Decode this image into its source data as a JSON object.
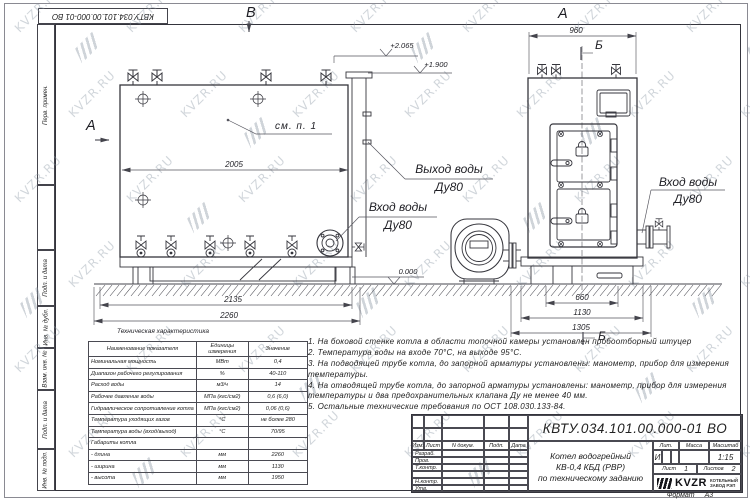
{
  "frame": {
    "doc_number_rotated": "КВТУ.034.101.00.000-01 ВО",
    "stamp_column": [
      "Перв. примен.",
      "",
      "Подп. и дата",
      "Инв. № дубл.",
      "Взам. инв. №",
      "Подп. и дата",
      "Инв. № подл."
    ],
    "format_label": "Формат",
    "format_value": "А3"
  },
  "views": {
    "left": {
      "view_marker_top": "В",
      "section_marker_side": "А",
      "callout": "см. п. 1",
      "elevation_top": "+2.065",
      "elevation_chimney": "+1.900",
      "elevation_ground": "0.000",
      "dim_length_shell": "2005",
      "dim_length_frame": "2135",
      "dim_length_overall": "2260",
      "outlet_label_line1": "Выход воды",
      "outlet_label_line2": "Ду80",
      "inlet_label_line1": "Вход воды",
      "inlet_label_line2": "Ду80"
    },
    "right": {
      "view_marker_top": "А",
      "section_marker_top": "Б",
      "section_marker_bottom": "Б",
      "dim_width_top": "960",
      "dim_width_1": "660",
      "dim_width_2": "1130",
      "dim_width_3": "1305",
      "inlet_label_line1": "Вход воды",
      "inlet_label_line2": "Ду80"
    }
  },
  "spec_table": {
    "title": "Техническая характеристика",
    "headers": [
      "Наименование показателя",
      "Единицы измерения",
      "Значение"
    ],
    "rows": [
      [
        "Номинальная мощность",
        "МВт",
        "0,4"
      ],
      [
        "Диапазон рабочего регулирования",
        "%",
        "40-110"
      ],
      [
        "Расход воды",
        "м3/ч",
        "14"
      ],
      [
        "Рабочее давление воды",
        "МПа (кгс/см2)",
        "0,6 (6,0)"
      ],
      [
        "Гидравлическое сопротивление котла",
        "МПа (кгс/см2)",
        "0,06 (0,6)"
      ],
      [
        "Температура уходящих газов",
        "°С",
        "не более 280"
      ],
      [
        "Температура воды (вход/выход)",
        "°С",
        "70/95"
      ],
      [
        "Габариты котла",
        "",
        ""
      ],
      [
        "- длина",
        "мм",
        "2260"
      ],
      [
        "- ширина",
        "мм",
        "1130"
      ],
      [
        "- высота",
        "мм",
        "1950"
      ]
    ]
  },
  "notes": [
    "1.  На боковой стенке котла в области топочной камеры установлен пробоотборный штуцер",
    "2.  Температура воды на входе 70°С, на выходе 95°С.",
    "3.  На подводящей трубе котла, до запорной арматуры установлены: манометр, прибор для измерения температуры.",
    "4.  На отводящей трубе котла, до запорной арматуры установлены: манометр, прибор для измерения температуры и два предохранительных клапана Ду не менее 40 мм.",
    "5.  Остальные технические требования по ОСТ 108.030.133-84."
  ],
  "title_block": {
    "doc_number": "КВТУ.034.101.00.000-01 ВО",
    "rev_cols": [
      "Изм.",
      "Лист",
      "N докум.",
      "Подп.",
      "Дата"
    ],
    "sign_rows": [
      "Разраб.",
      "Пров.",
      "Т.контр.",
      "",
      "Н.контр.",
      "Утв."
    ],
    "product_line1": "Котел водогрейный",
    "product_line2": "КВ-0,4  КБД  (РВР)",
    "product_line3": "по техническому заданию",
    "lit_label": "Лит.",
    "lit_value": "И",
    "mass_label": "Масса",
    "scale_label": "Масштаб",
    "scale_value": "1:15",
    "sheet_label": "Лист",
    "sheet_value": "1",
    "sheets_label": "Листов",
    "sheets_value": "2",
    "logo_text": "KVZR",
    "logo_caption_line1": "КОТЕЛЬНЫЙ",
    "logo_caption_line2": "ЗАВОД РЭП"
  },
  "watermark": {
    "text": "KVZR.RU"
  }
}
